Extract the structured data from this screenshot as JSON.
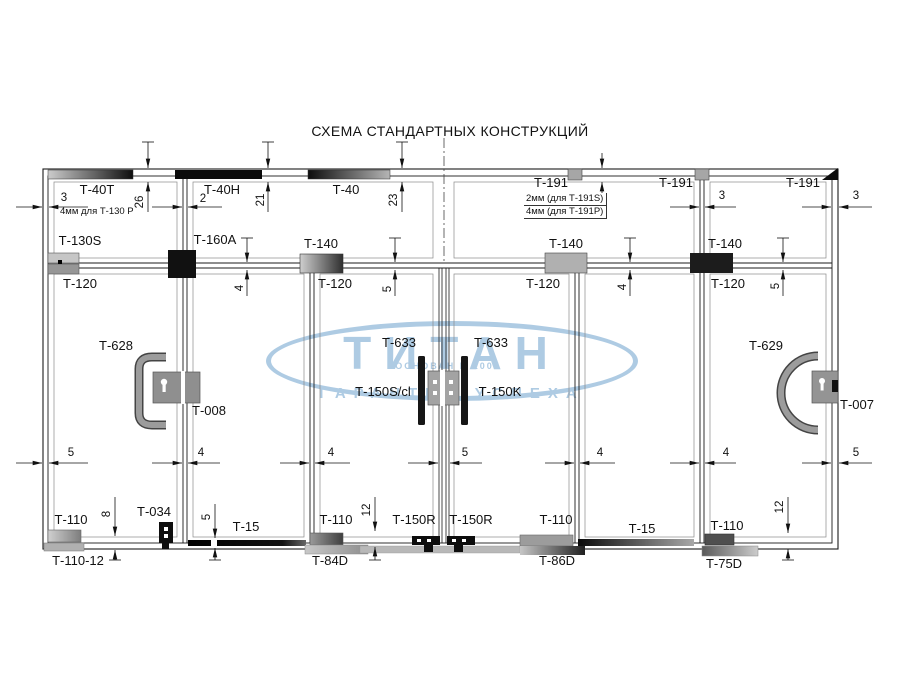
{
  "title": "СХЕМА СТАНДАРТНЫХ КОНСТРУКЦИЙ",
  "watermark": {
    "brand": "ТИТАН",
    "founded": "ОСНОВАН В 2005",
    "slogan": "ГАРАНТИЯ УСПЕХА",
    "color": "#aecbe3"
  },
  "notes": {
    "left": "4мм для Т-130 Р",
    "box_line1": "2мм (для Т-191S)",
    "box_line2": "4мм (для Т-191P)"
  },
  "labels": {
    "t40t": "Т-40Т",
    "t40h": "Т-40Н",
    "t40": "Т-40",
    "t191_1": "Т-191",
    "t191_2": "Т-191",
    "t191_3": "Т-191",
    "t130s": "Т-130S",
    "t160a": "Т-160А",
    "t140_1": "Т-140",
    "t140_2": "Т-140",
    "t140_3": "Т-140",
    "t120_1": "Т-120",
    "t120_2": "Т-120",
    "t120_3": "Т-120",
    "t120_4": "Т-120",
    "t628": "Т-628",
    "t008": "Т-008",
    "t633_1": "Т-633",
    "t633_2": "Т-633",
    "t150s": "Т-150S/cl",
    "t150k": "Т-150K",
    "t629": "Т-629",
    "t007": "Т-007",
    "t110_1": "Т-110",
    "t110_2": "Т-110",
    "t110_3": "Т-110",
    "t110_4": "Т-110",
    "t110_12": "Т-110-12",
    "t034": "Т-034",
    "t15_1": "Т-15",
    "t15_2": "Т-15",
    "t84d": "Т-84D",
    "t86d": "Т-86D",
    "t75d": "Т-75D",
    "t150r_1": "Т-150R",
    "t150r_2": "Т-150R"
  },
  "dimensions": {
    "top": {
      "d3_left": "3",
      "d26": "26",
      "d2": "2",
      "d21": "21",
      "d23": "23",
      "d3_mid": "3",
      "d3_right": "3"
    },
    "transom": {
      "d4_1": "4",
      "d5_1": "5",
      "d4_2": "4",
      "d5_2": "5"
    },
    "middle": {
      "d5_1": "5",
      "d4_1": "4",
      "d4_2": "4",
      "d5_2": "5",
      "d4_3": "4",
      "d4_4": "4",
      "d5_3": "5"
    },
    "bottom": {
      "d8": "8",
      "d5": "5",
      "d12_1": "12",
      "d12_2": "12"
    }
  }
}
